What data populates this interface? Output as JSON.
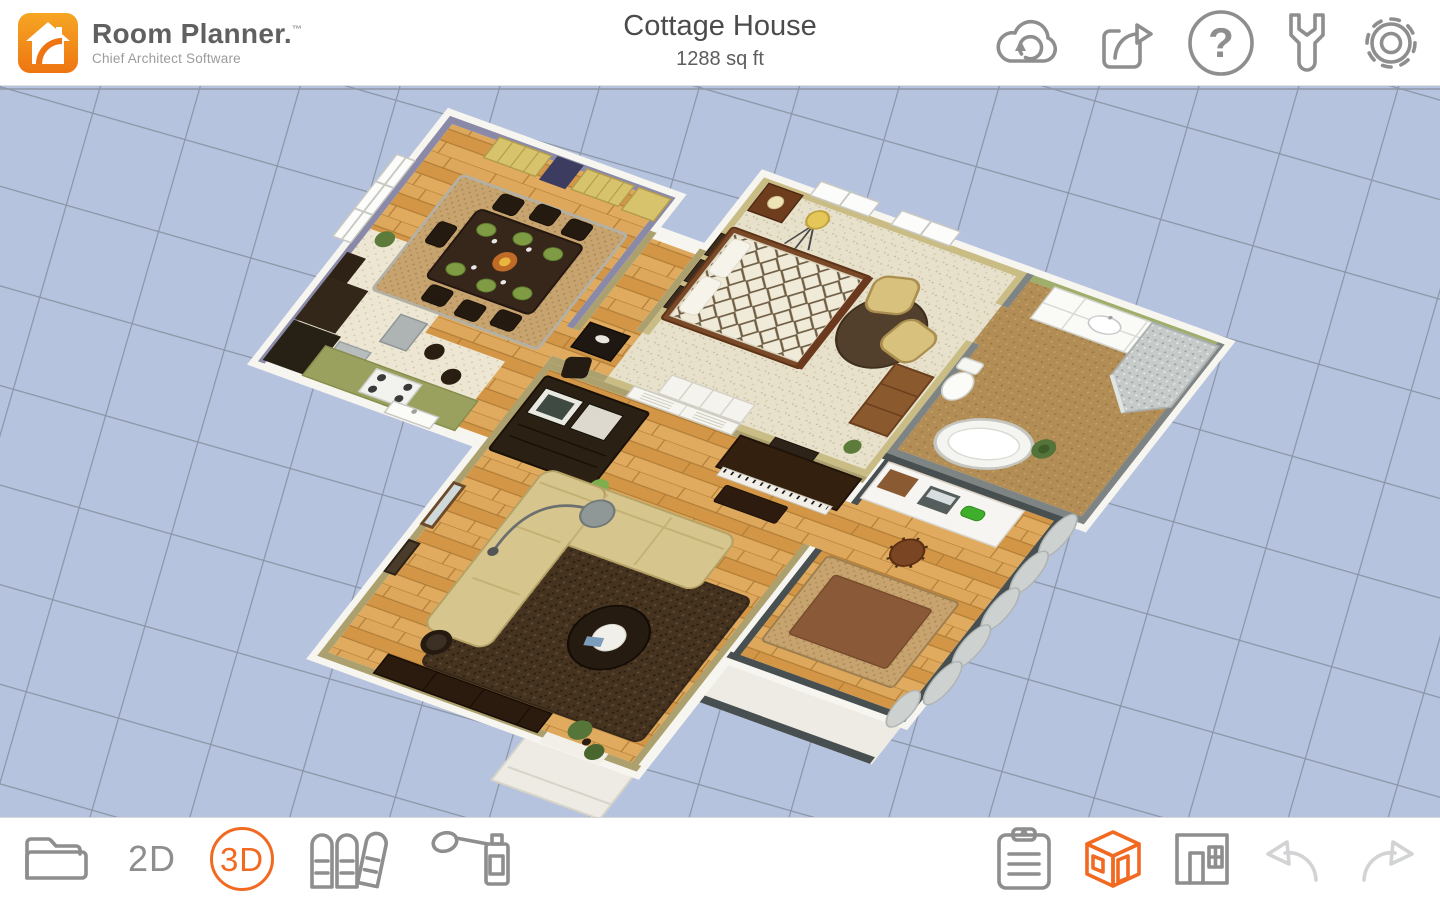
{
  "app_window": {
    "title": "Cottage House",
    "area": "1288 sq ft"
  },
  "brand": {
    "logo_text": "Room Planner.",
    "trademark": "™",
    "tagline": "Chief Architect Software"
  },
  "top_toolbar": {
    "buttons": [
      {
        "name": "cloud-sync"
      },
      {
        "name": "share-export"
      },
      {
        "name": "help"
      },
      {
        "name": "tools-wrench"
      },
      {
        "name": "settings-gear"
      }
    ]
  },
  "bottom_toolbar": {
    "left": [
      {
        "name": "projects-folder"
      },
      {
        "name": "view-2d",
        "label": "2D",
        "active": false
      },
      {
        "name": "view-3d",
        "label": "3D",
        "active": true
      },
      {
        "name": "catalog-books"
      },
      {
        "name": "paint-sprayer"
      }
    ],
    "right": [
      {
        "name": "project-details-clipboard"
      },
      {
        "name": "view-mode-3d-house",
        "active": true
      },
      {
        "name": "view-mode-floorplan"
      },
      {
        "name": "undo",
        "enabled": false
      },
      {
        "name": "redo",
        "enabled": false
      }
    ]
  },
  "view": {
    "mode": "3D",
    "plan_name": "Cottage House"
  },
  "colors": {
    "accent": "#f26a21",
    "icon": "#8e8e8e",
    "icon_disabled": "#d2d3d5",
    "canvas_bg": "#b6c3de",
    "grid_line": "#7f8897",
    "wall_white": "#f7f5ef",
    "wood_floor": "#d8a050",
    "dining_wall_purple": "#8a8aa8",
    "bedroom_wall_tan": "#c9bd85",
    "living_wall_olive": "#aba06e",
    "bath_wall_green": "#9fae6b",
    "bath_wall_gray": "#7e8484",
    "office_wall_charcoal": "#474f50",
    "carpet": "#e6e0ca",
    "bath_floor": "#b28d55"
  },
  "scene": {
    "rooms": [
      {
        "name": "kitchen-dining"
      },
      {
        "name": "bedroom"
      },
      {
        "name": "bathroom"
      },
      {
        "name": "living-room"
      },
      {
        "name": "office"
      },
      {
        "name": "hallway"
      }
    ]
  }
}
